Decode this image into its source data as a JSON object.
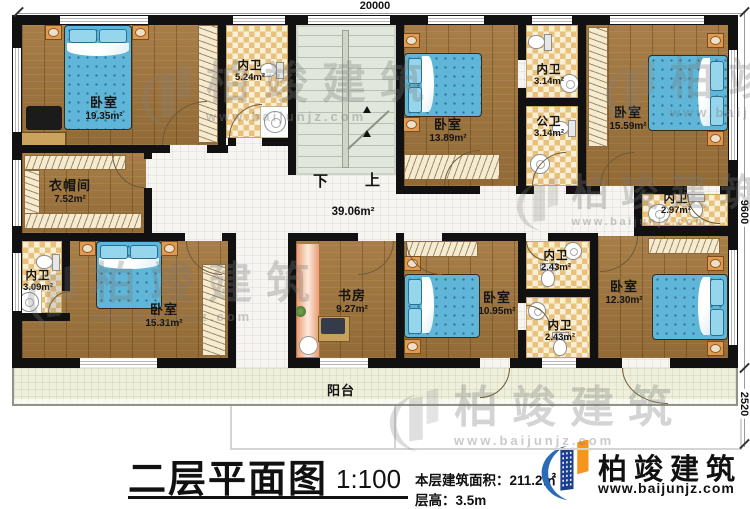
{
  "dimensions": {
    "top": "20000",
    "right_upper": "9600",
    "right_lower": "2520"
  },
  "stairs": {
    "down": "下",
    "up": "上"
  },
  "hall": {
    "area": "39.06m²"
  },
  "rooms": {
    "bd_tl": {
      "name": "卧室",
      "area": "19.35m²"
    },
    "bath_tl": {
      "name": "内卫",
      "area": "5.24m²"
    },
    "bd_tm": {
      "name": "卧室",
      "area": "13.89m²"
    },
    "bath_tm": {
      "name": "内卫",
      "area": "3.14m²"
    },
    "bath_pub": {
      "name": "公卫",
      "area": "3.14m²"
    },
    "bd_tr": {
      "name": "卧室",
      "area": "15.59m²"
    },
    "bath_tr": {
      "name": "内卫",
      "area": "2.97m²"
    },
    "cloak": {
      "name": "衣帽间",
      "area": "7.52m²"
    },
    "bath_bl": {
      "name": "内卫",
      "area": "3.09m²"
    },
    "bd_bl": {
      "name": "卧室",
      "area": "15.31m²"
    },
    "study": {
      "name": "书房",
      "area": "9.27m²"
    },
    "bd_bm": {
      "name": "卧室",
      "area": "10.95m²"
    },
    "bath_bm1": {
      "name": "内卫",
      "area": "2.43m²"
    },
    "bath_bm2": {
      "name": "内卫",
      "area": "2.43m²"
    },
    "bd_br": {
      "name": "卧室",
      "area": "12.30m²"
    },
    "balcony": {
      "name": "阳台"
    }
  },
  "title_block": {
    "title": "二层平面图",
    "scale": "1:100",
    "area_label": "本层建筑面积：211.2㎡",
    "floor_height": "层高：3.5m"
  },
  "brand": {
    "name": "柏竣建筑",
    "url": "www.baijunjz.com"
  },
  "watermark": {
    "name": "柏竣建筑",
    "url": "www.baijunjz.com"
  },
  "colors": {
    "brand_blue": "#1c3f8e",
    "brand_orange": "#f7941d",
    "wall": "#111111",
    "wood": "#a2763c"
  }
}
